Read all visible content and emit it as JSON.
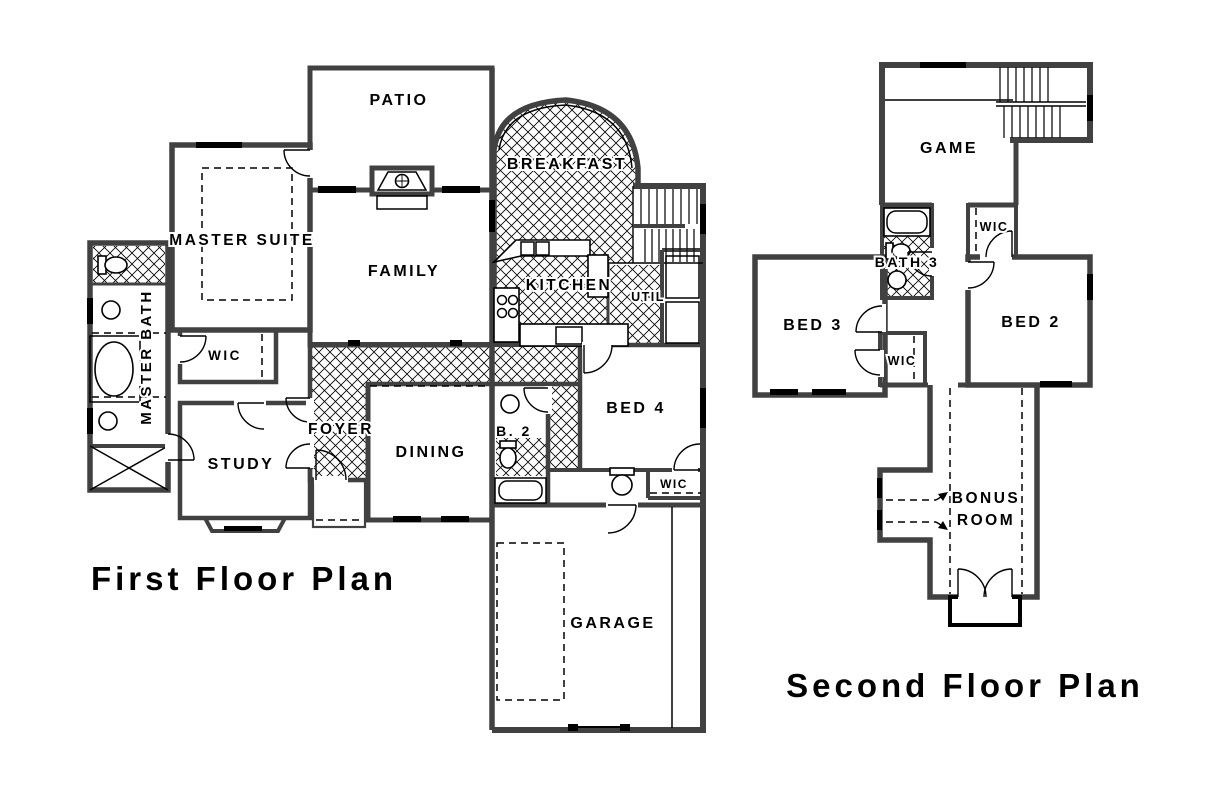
{
  "drawing": {
    "type": "architectural-floor-plan",
    "background": "#ffffff",
    "wall_color": "#414141",
    "line_color": "#000000"
  },
  "first_floor": {
    "title": "First Floor Plan",
    "rooms": {
      "patio": "PATIO",
      "breakfast": "BREAKFAST",
      "master_suite": "MASTER SUITE",
      "family": "FAMILY",
      "kitchen": "KITCHEN",
      "util": "UTIL",
      "master_bath": "MASTER BATH",
      "wic": "WIC",
      "foyer": "FOYER",
      "dining": "DINING",
      "study": "STUDY",
      "bath2": "B. 2",
      "bed4": "BED 4",
      "bed4_wic": "WIC",
      "garage": "GARAGE"
    }
  },
  "second_floor": {
    "title": "Second Floor Plan",
    "rooms": {
      "game": "GAME",
      "bath3": "BATH 3",
      "bed2_wic": "WIC",
      "bed3": "BED 3",
      "bed2": "BED 2",
      "bed3_wic": "WIC",
      "bonus_line1": "BONUS",
      "bonus_line2": "ROOM"
    }
  }
}
